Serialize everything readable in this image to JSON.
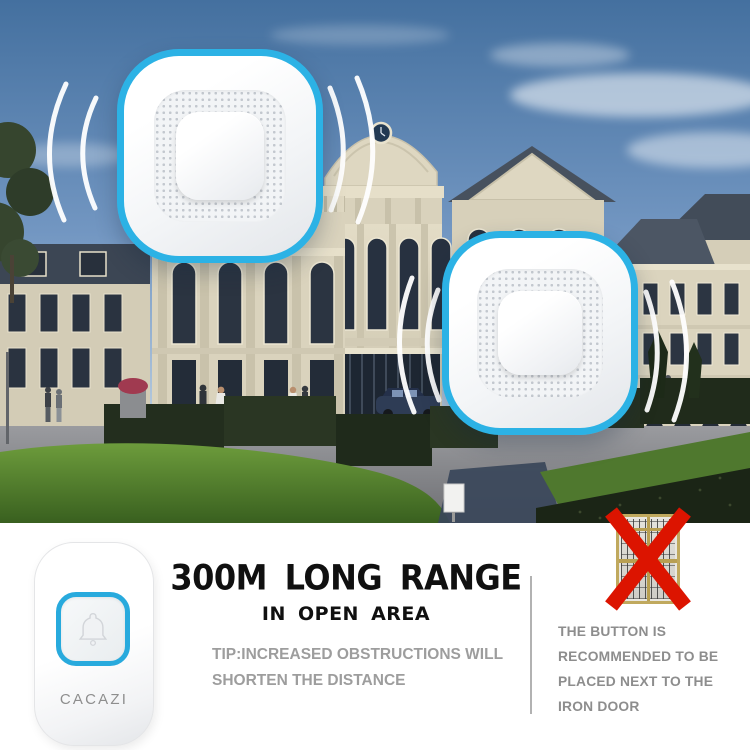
{
  "product": {
    "brand": "CACAZI"
  },
  "headline": {
    "title": "300M LONG RANGE",
    "subtitle": "IN OPEN AREA",
    "tip_line1": "TIP:INCREASED OBSTRUCTIONS WILL",
    "tip_line2": "SHORTEN THE DISTANCE"
  },
  "warning": {
    "lines": [
      "THE BUTTON IS",
      "RECOMMENDED TO BE",
      "PLACED NEXT TO THE",
      "IRON DOOR"
    ]
  },
  "icons": {
    "bell": "bell-outline-icon",
    "cross": "red-x-mark-icon",
    "signal": "radio-wave-arcs-icon"
  },
  "colors": {
    "accent_blue": "#2cb2e5",
    "cross_red": "#dc1400",
    "title_black": "#101010",
    "tip_gray": "#9d9d9d",
    "caption_gray": "#8d8d8d",
    "divider_gray": "#b2b2b2",
    "door_frame_gold": "#c0a95e",
    "sky_top": "#44709f",
    "sky_horizon": "#d3dfe9",
    "facade_cream": "#d9d2bc",
    "roof_slate": "#47515f",
    "lawn_green": "#4e7a2c",
    "hedge_green": "#232e1e",
    "plaza_gray": "#909195"
  }
}
